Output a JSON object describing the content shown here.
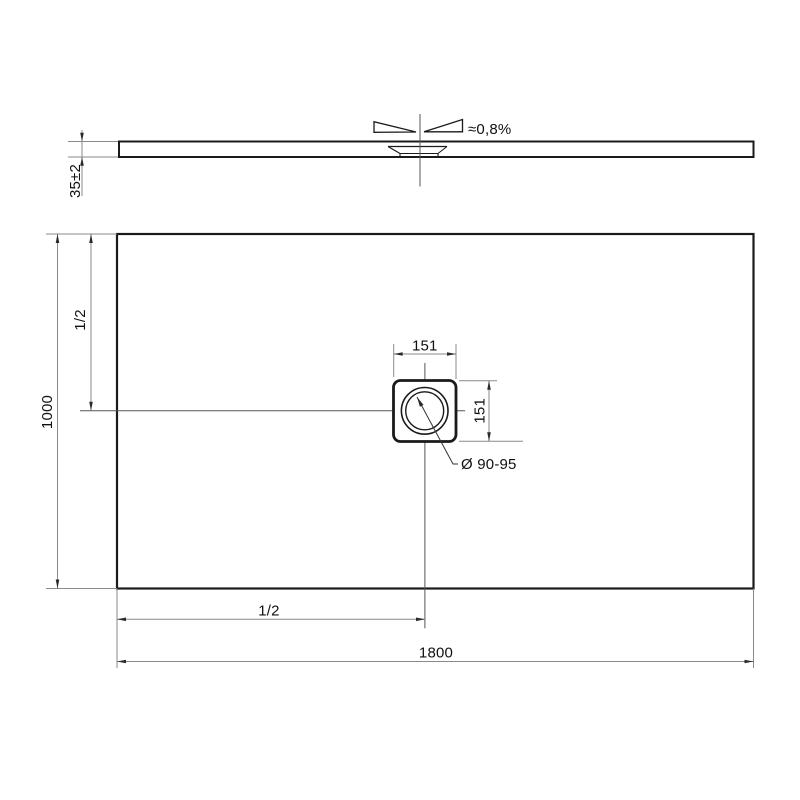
{
  "drawing": {
    "type": "shower-tray-technical-drawing",
    "side_view": {
      "slope_label": "≈0,8%",
      "thickness_label": "35±2"
    },
    "plan_view": {
      "depth_label": "1000",
      "width_label": "1800",
      "half_depth_label": "1/2",
      "half_width_label": "1/2",
      "drain_width_label": "151",
      "drain_height_label": "151",
      "drain_diameter_label": "Ø 90-95"
    },
    "colors": {
      "background": "#ffffff",
      "object_line": "#1a1a1a",
      "dimension_line": "#8a8a8a",
      "centerline": "#555555",
      "text": "#111111"
    }
  }
}
